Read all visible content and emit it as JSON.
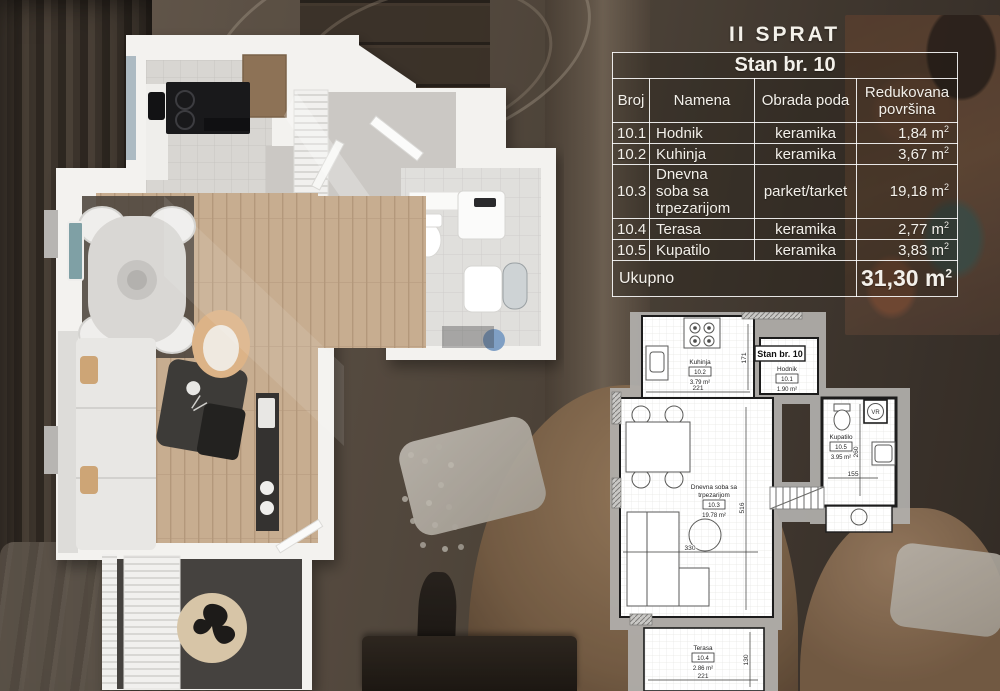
{
  "header": {
    "floor_title": "II SPRAT"
  },
  "table": {
    "title": "Stan br. 10",
    "columns": {
      "broj": "Broj",
      "namena": "Namena",
      "obrada": "Obrada poda",
      "povrsina_line1": "Redukovana",
      "povrsina_line2": "površina"
    },
    "unit": "m",
    "unit_sup": "2",
    "rows": [
      {
        "broj": "10.1",
        "namena": "Hodnik",
        "obrada": "keramika",
        "povrsina": "1,84"
      },
      {
        "broj": "10.2",
        "namena": "Kuhinja",
        "obrada": "keramika",
        "povrsina": "3,67"
      },
      {
        "broj": "10.3",
        "namena": "Dnevna soba sa trpezarijom",
        "obrada": "parket/tarket",
        "povrsina": "19,18"
      },
      {
        "broj": "10.4",
        "namena": "Terasa",
        "obrada": "keramika",
        "povrsina": "2,77"
      },
      {
        "broj": "10.5",
        "namena": "Kupatilo",
        "obrada": "keramika",
        "povrsina": "3,83"
      }
    ],
    "total_label": "Ukupno",
    "total_value": "31,30"
  },
  "plan2d": {
    "apartment_label": "Stan br. 10",
    "rooms": {
      "kuhinja": {
        "name": "Kuhinja",
        "num": "10.2",
        "area": "3.79 m²"
      },
      "hodnik": {
        "name": "Hodnik",
        "num": "10.1",
        "area": "1.90 m²"
      },
      "kupatilo": {
        "name": "Kupatilo",
        "num": "10.5",
        "area": "3.95 m²"
      },
      "dnevna": {
        "name_line1": "Dnevna soba sa",
        "name_line2": "trpezarijom",
        "num": "10.3",
        "area": "19.78 m²"
      },
      "terasa": {
        "name": "Terasa",
        "num": "10.4",
        "area": "2.86 m²"
      }
    },
    "dims": {
      "kuhinja_w": "221",
      "kuhinja_h": "171",
      "kupatilo_w": "155",
      "kupatilo_h": "260",
      "dnevna_w": "330",
      "dnevna_h": "516",
      "terasa_w": "221",
      "terasa_h": "130"
    },
    "shaft_label": "VR"
  }
}
